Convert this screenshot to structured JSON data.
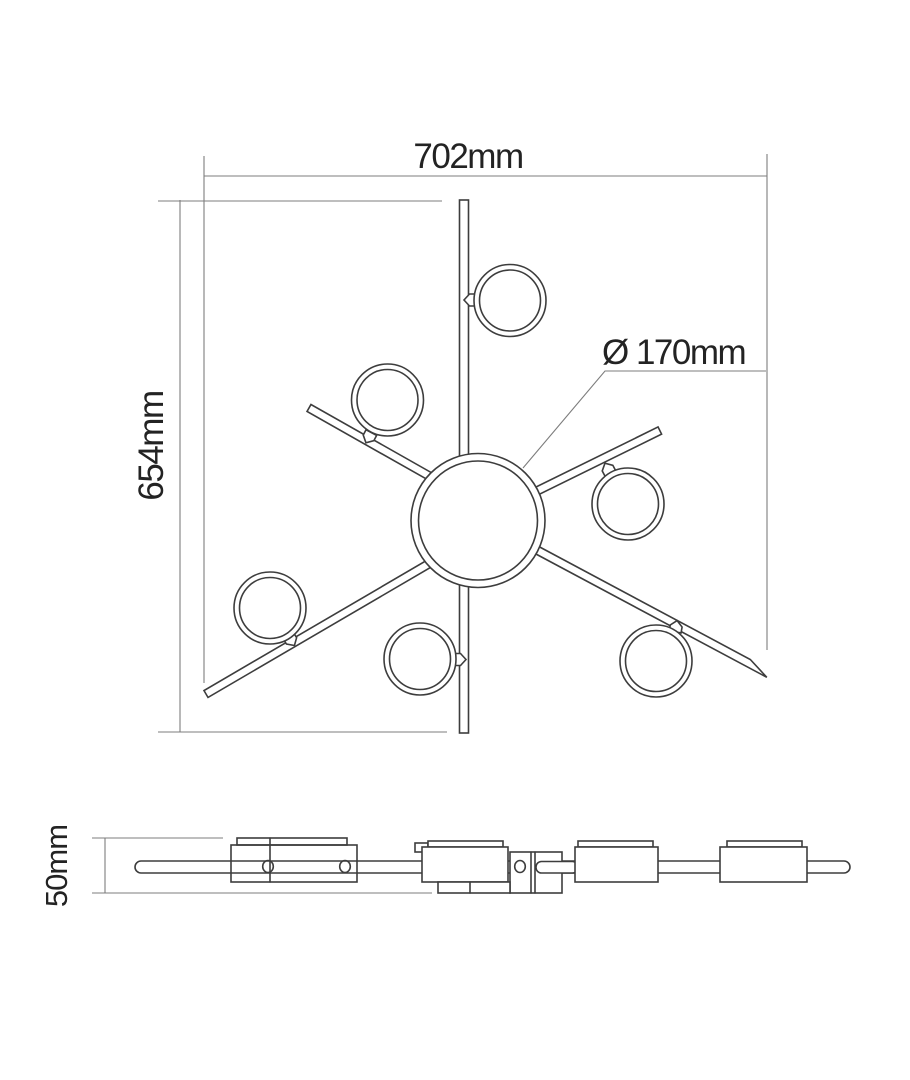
{
  "drawing": {
    "type": "technical-line-drawing",
    "subject": "ceiling-light-fixture",
    "views": [
      "top-view",
      "side-view"
    ],
    "dimensions": {
      "width": {
        "label": "702mm"
      },
      "height": {
        "label": "654mm"
      },
      "center_diameter": {
        "label": "Ø 170mm"
      },
      "side_height": {
        "label": "50mm"
      }
    },
    "colors": {
      "background": "#ffffff",
      "outline": "#3d3d3d",
      "dimension_line": "#7d7d7d",
      "text": "#232323"
    }
  }
}
